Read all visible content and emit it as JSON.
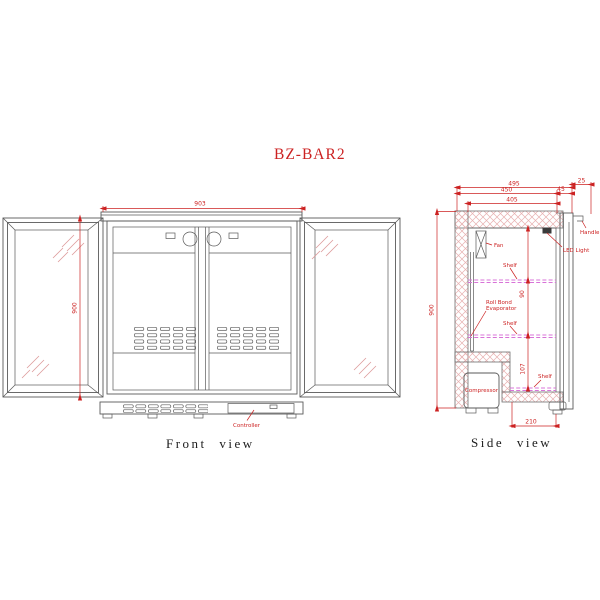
{
  "title": "BZ-BAR2",
  "front_view": {
    "caption": "Front view",
    "dim_width": "903",
    "dim_height": "900",
    "controller_label": "Controller"
  },
  "side_view": {
    "caption": "Side view",
    "dim_depth_overall": "495",
    "dim_door_thickness": "25",
    "dim_depth_mid": "450",
    "dim_front_frame": "45",
    "dim_interior_depth": "405",
    "dim_height": "900",
    "dim_shelf_gap_upper": "90",
    "dim_shelf_gap_lower": "107",
    "dim_bottom_depth": "210",
    "labels": {
      "handle": "Handle",
      "led_light": "LED Light",
      "fan": "Fan",
      "shelf": "Shelf",
      "evaporator_line1": "Roll Bond",
      "evaporator_line2": "Evaporator",
      "compressor": "Compressor"
    }
  },
  "colors": {
    "line": "#5a5a5a",
    "annotation_red": "#cc2222",
    "shelf_magenta": "#d873d8",
    "insulation_hatch": "#e7b0b0",
    "background": "#ffffff"
  }
}
